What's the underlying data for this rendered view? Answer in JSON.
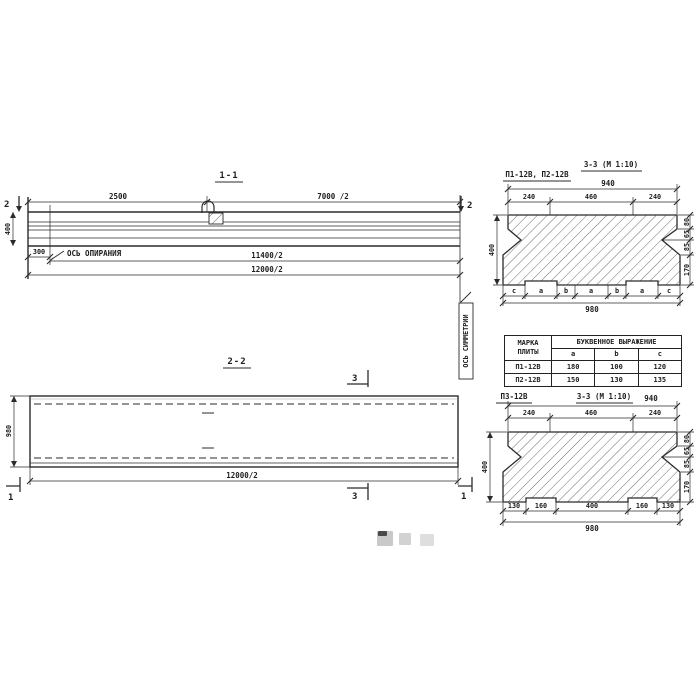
{
  "palette": {
    "ink": "#2b2b2b",
    "hatch": "#6f6f6f",
    "paper": "#ffffff"
  },
  "section11": {
    "title": "1-1",
    "cut_marker": "2",
    "dim_2500": "2500",
    "dim_7000_2": "7000 /2",
    "dim_400": "400",
    "dim_300": "300",
    "dim_11400_2": "11400/2",
    "dim_12000_2": "12000/2",
    "support_axis_label": "ОСЬ ОПИРАНИЯ",
    "symmetry_axis_label": "ОСЬ СИММЕТРИИ"
  },
  "section22": {
    "title": "2-2",
    "cut_marker_3": "3",
    "cut_marker_1": "1",
    "dim_980": "980",
    "dim_12000_2": "12000/2"
  },
  "csTop": {
    "label": "П1-12В, П2-12В",
    "title": "3-3 (М 1:10)",
    "dim_940": "940",
    "dim_240_left": "240",
    "dim_460": "460",
    "dim_240_right": "240",
    "dim_400": "400",
    "dim_980": "980",
    "right_dims": [
      "80",
      "65",
      "85",
      "170"
    ],
    "letters": [
      "c",
      "a",
      "b",
      "a",
      "b",
      "a",
      "c"
    ]
  },
  "table": {
    "header_mark": "МАРКА ПЛИТЫ",
    "header_expr": "БУКВЕННОЕ ВЫРАЖЕНИЕ",
    "columns": [
      "a",
      "b",
      "c"
    ],
    "rows": [
      [
        "П1-12В",
        "180",
        "100",
        "120"
      ],
      [
        "П2-12В",
        "150",
        "130",
        "135"
      ]
    ]
  },
  "csBottom": {
    "label": "П3-12В",
    "title": "3-3 (М 1:10)",
    "dim_940": "940",
    "dim_240_left": "240",
    "dim_460": "460",
    "dim_240_right": "240",
    "dim_400": "400",
    "dim_980": "980",
    "right_dims": [
      "80",
      "65",
      "85",
      "170"
    ],
    "bottom_dims": [
      "130",
      "160",
      "400",
      "160",
      "130"
    ]
  }
}
